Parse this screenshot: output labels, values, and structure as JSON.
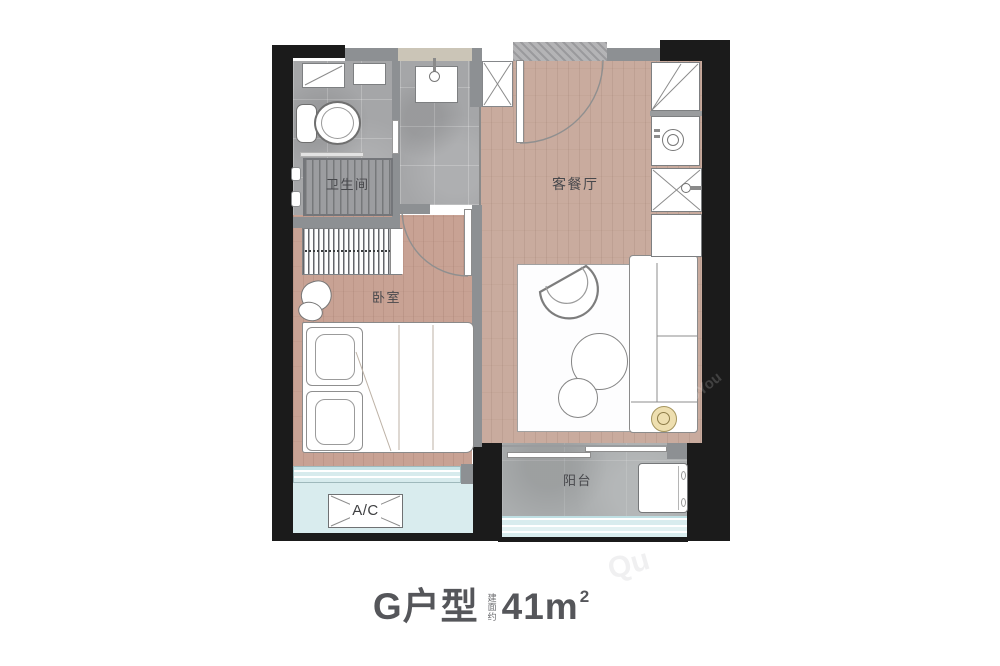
{
  "floor_plan": {
    "unit": "G",
    "rooms": [
      {
        "id": "bathroom",
        "label": "卫生间"
      },
      {
        "id": "living_dining",
        "label": "客餐厅"
      },
      {
        "id": "bedroom",
        "label": "卧室"
      },
      {
        "id": "balcony",
        "label": "阳台"
      }
    ],
    "equipment": {
      "ac_unit_label": "A/C"
    },
    "icons": [
      "toilet-icon",
      "shower-area",
      "washbasin-icon",
      "shaft-cross",
      "fridge-icon",
      "washing-machine-icon",
      "kitchen-sink-icon",
      "sofa-icon",
      "armchair-icon",
      "coffee-table-icon",
      "bed-icon",
      "pillow-icon",
      "wardrobe-icon",
      "balcony-washer-icon",
      "door-swing-arc",
      "floor-lamp-icon"
    ],
    "colors": {
      "wall_black": "#1b1b1b",
      "wall_gray": "#8d9093",
      "wood_floor_living": "#c9ab9e",
      "wood_floor_bedroom": "#c8a294",
      "tile_gray": "#a5a6a8",
      "balcony_concrete": "#aaadae",
      "glass_cyan": "#d9ecee",
      "backsplash_beige": "#cbc5b7",
      "accent_gold": "#eedfb0",
      "caption_text": "#55565a"
    }
  },
  "caption": {
    "unit_name": "G户型",
    "area_qualifier": "建面约",
    "area_value": "41m",
    "area_exponent": "2"
  },
  "watermark": {
    "fragments": [
      "9You",
      "Qu"
    ]
  }
}
